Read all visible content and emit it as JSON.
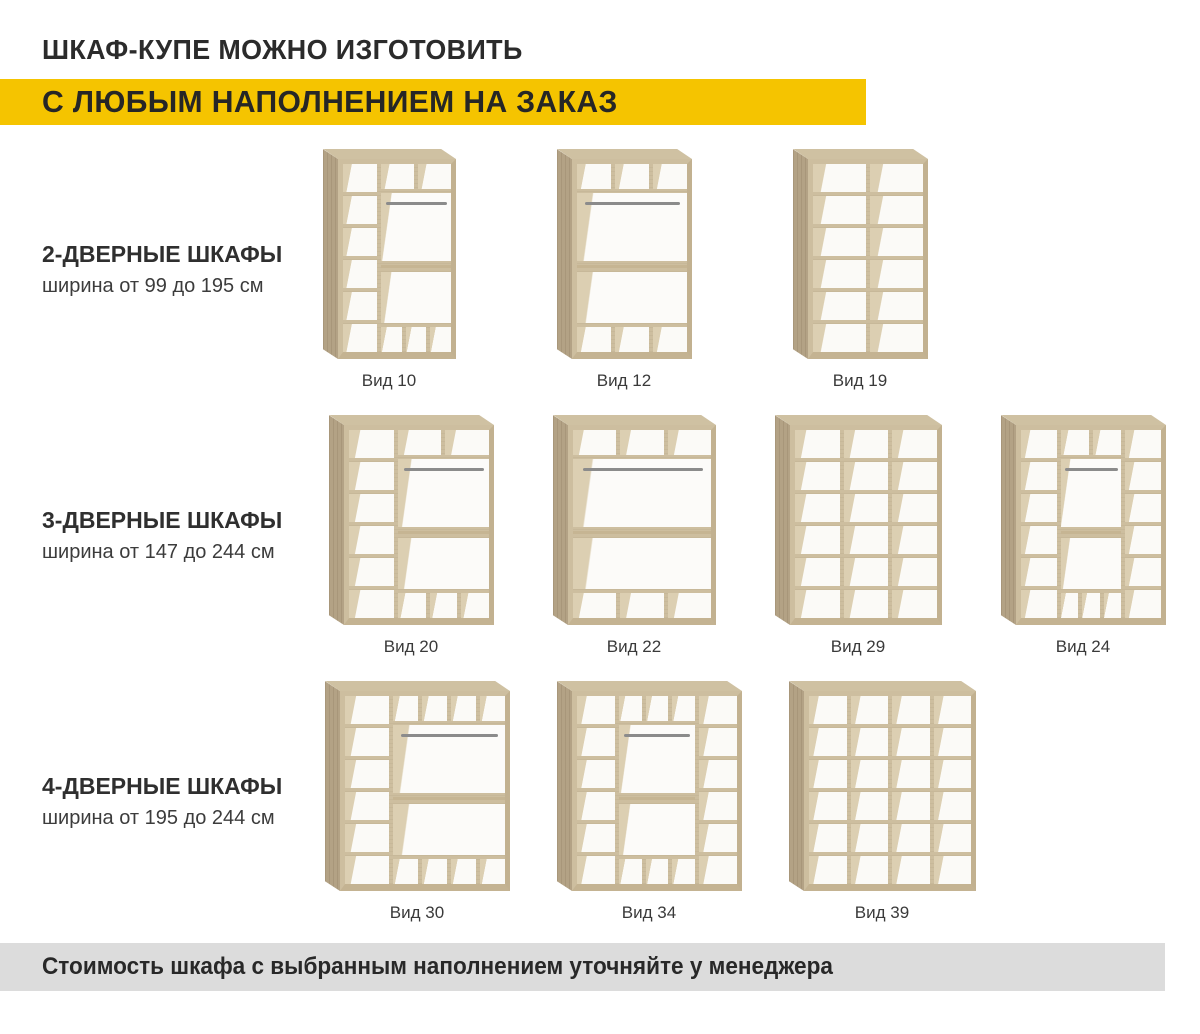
{
  "header": {
    "line1": "ШКАФ-КУПЕ МОЖНО ИЗГОТОВИТЬ",
    "line2": "С ЛЮБЫМ НАПОЛНЕНИЕМ НА ЗАКАЗ",
    "highlight_color": "#F5C400"
  },
  "rows": [
    {
      "title": "2-ДВЕРНЫЕ ШКАФЫ",
      "subtitle": "ширина от 99 до 195 см",
      "items": [
        {
          "caption": "Вид 10",
          "figure": {
            "w": 118,
            "h": 200,
            "columns": [
              {
                "kind": "shelves",
                "rows": 6,
                "flex": 33
              },
              {
                "kind": "hang",
                "flex": 67,
                "top": 2,
                "bottom": 3
              }
            ]
          }
        },
        {
          "caption": "Вид 12",
          "figure": {
            "w": 120,
            "h": 200,
            "columns": [
              {
                "kind": "hang",
                "flex": 1,
                "top": 3,
                "bottom": 3
              }
            ]
          }
        },
        {
          "caption": "Вид 19",
          "figure": {
            "w": 120,
            "h": 200,
            "columns": [
              {
                "kind": "shelves",
                "rows": 6,
                "flex": 1
              },
              {
                "kind": "shelves",
                "rows": 6,
                "flex": 1
              }
            ]
          }
        }
      ]
    },
    {
      "title": "3-ДВЕРНЫЕ ШКАФЫ",
      "subtitle": "ширина от 147 до 244 см",
      "items": [
        {
          "caption": "Вид 20",
          "figure": {
            "w": 150,
            "h": 200,
            "columns": [
              {
                "kind": "shelves",
                "rows": 6,
                "flex": 33
              },
              {
                "kind": "hang",
                "flex": 67,
                "top": 2,
                "bottom": 3
              }
            ]
          }
        },
        {
          "caption": "Вид 22",
          "figure": {
            "w": 148,
            "h": 200,
            "columns": [
              {
                "kind": "hang",
                "flex": 1,
                "top": 3,
                "bottom": 3
              }
            ]
          }
        },
        {
          "caption": "Вид 29",
          "figure": {
            "w": 152,
            "h": 200,
            "columns": [
              {
                "kind": "shelves",
                "rows": 6,
                "flex": 1
              },
              {
                "kind": "shelves",
                "rows": 6,
                "flex": 1
              },
              {
                "kind": "shelves",
                "rows": 6,
                "flex": 1
              }
            ]
          }
        },
        {
          "caption": "Вид 24",
          "figure": {
            "w": 150,
            "h": 200,
            "columns": [
              {
                "kind": "shelves",
                "rows": 6,
                "flex": 27
              },
              {
                "kind": "hang",
                "flex": 46,
                "top": 2,
                "bottom": 3
              },
              {
                "kind": "shelves",
                "rows": 6,
                "flex": 27
              }
            ]
          }
        }
      ]
    },
    {
      "title": "4-ДВЕРНЫЕ ШКАФЫ",
      "subtitle": "ширина от 195 до 244 см",
      "items": [
        {
          "caption": "Вид 30",
          "figure": {
            "w": 170,
            "h": 200,
            "columns": [
              {
                "kind": "shelves",
                "rows": 6,
                "flex": 28
              },
              {
                "kind": "hang",
                "flex": 72,
                "top": 4,
                "bottom": 4
              }
            ]
          }
        },
        {
          "caption": "Вид 34",
          "figure": {
            "w": 170,
            "h": 200,
            "columns": [
              {
                "kind": "shelves",
                "rows": 6,
                "flex": 25
              },
              {
                "kind": "hang",
                "flex": 50,
                "top": 3,
                "bottom": 3
              },
              {
                "kind": "shelves",
                "rows": 6,
                "flex": 25
              }
            ]
          }
        },
        {
          "caption": "Вид 39",
          "figure": {
            "w": 172,
            "h": 200,
            "columns": [
              {
                "kind": "shelves",
                "rows": 6,
                "flex": 1
              },
              {
                "kind": "shelves",
                "rows": 6,
                "flex": 1
              },
              {
                "kind": "shelves",
                "rows": 6,
                "flex": 1
              },
              {
                "kind": "shelves",
                "rows": 6,
                "flex": 1
              }
            ]
          }
        }
      ]
    }
  ],
  "footer": {
    "text": "Стоимость шкафа с выбранным наполнением уточняйте у менеджера",
    "bg": "#DCDCDC"
  },
  "colors": {
    "yellow": "#F5C400",
    "wood_frame": "#CDBE9F",
    "wood_side": "#B3A285",
    "wood_top": "#CFC1A2",
    "wood_wall": "#DCCFB2",
    "rod": "#8B8B8B",
    "text_dark": "#2B2B2B",
    "caption": "#3A3A3A",
    "footer_bg": "#DCDCDC"
  }
}
